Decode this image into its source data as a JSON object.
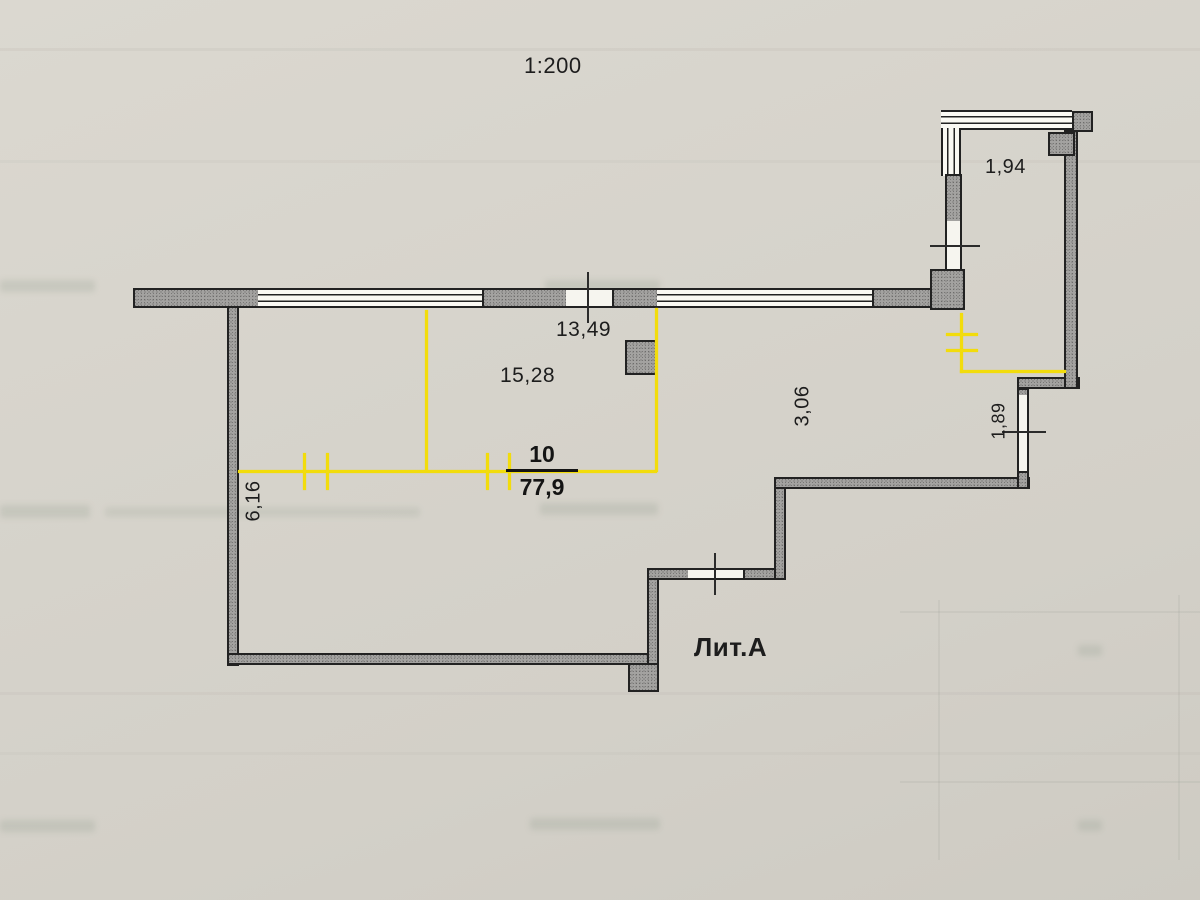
{
  "scale_label": "1:200",
  "building_label": "Лит.А",
  "room": {
    "number": "10",
    "area": "77,9"
  },
  "dimensions": {
    "top_facade_width": "13,49",
    "room_width": "15,28",
    "right_section_depth": "3,06",
    "balcony_width": "1,94",
    "balcony_side_depth": "1,89",
    "left_wall_height": "6,16"
  },
  "colors": {
    "dimension_accent": "#f2dc0c",
    "wall_fill": "#a3a2a0",
    "paper": "#d6d3cb",
    "ink": "#1d1d1d"
  }
}
